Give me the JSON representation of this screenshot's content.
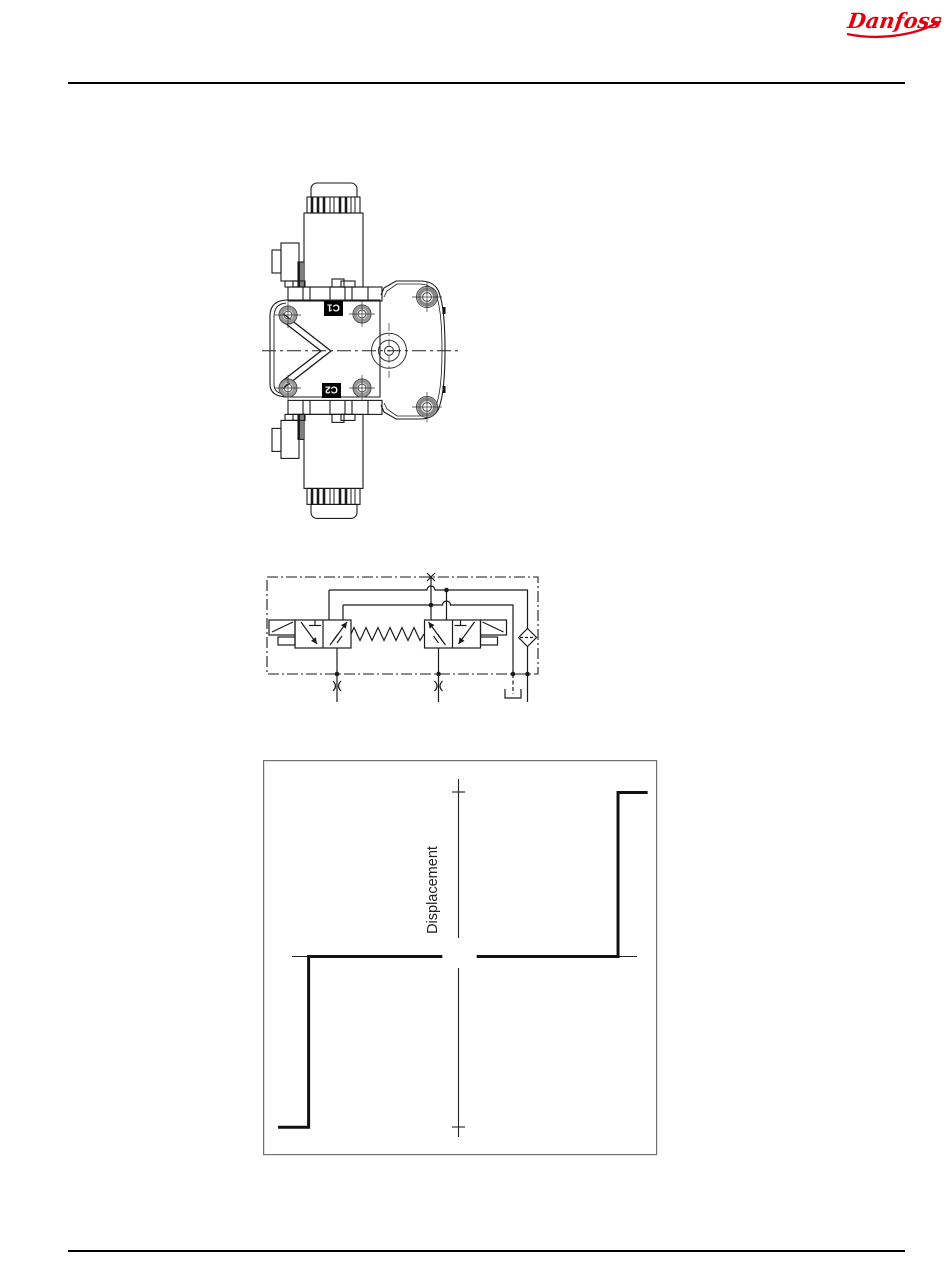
{
  "page": {
    "logo_text": "Danfoss",
    "logo_color": "#e2000f"
  },
  "valve_drawing": {
    "port_labels": {
      "top": "C1",
      "bottom": "C2"
    }
  },
  "chart": {
    "ylabel": "Displacement"
  },
  "chart_data": {
    "type": "line",
    "title": "",
    "xlabel": "",
    "ylabel": "Displacement",
    "xlim": [
      -1,
      1
    ],
    "ylim": [
      -1,
      1
    ],
    "grid": false,
    "legend": "none",
    "axes_style": "centered cross axes, no numeric tick labels, tick marks at positive and negative maximum displacement",
    "series": [
      {
        "name": "negative_branch",
        "x": [
          -0.95,
          -0.79,
          -0.79,
          -0.09
        ],
        "y": [
          -0.885,
          -0.885,
          0,
          0
        ]
      },
      {
        "name": "positive_branch",
        "x": [
          0.09,
          0.83,
          0.83,
          0.985
        ],
        "y": [
          0,
          0,
          0.85,
          0.85
        ]
      }
    ]
  }
}
